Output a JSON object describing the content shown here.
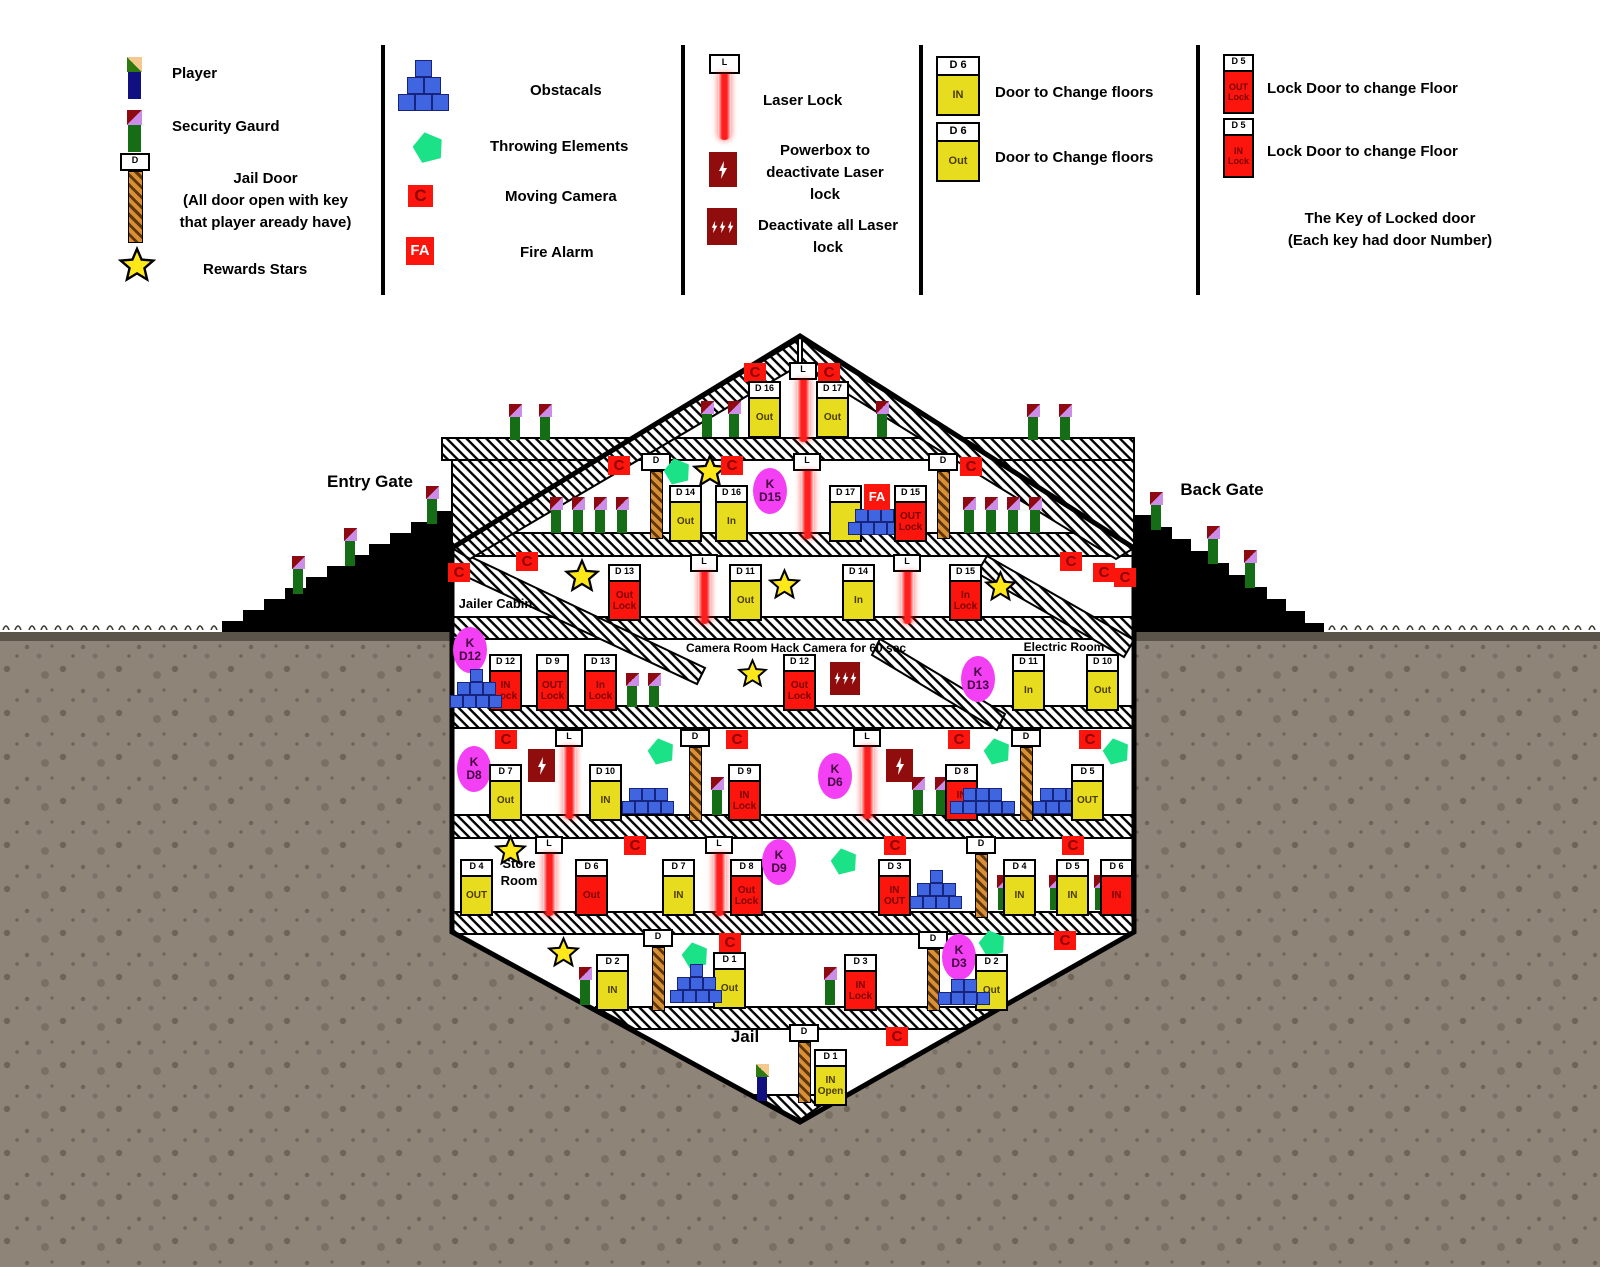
{
  "legend": {
    "player": "Player",
    "guard": "Security Gaurd",
    "jail_door": "Jail Door\n(All door open with key\nthat player aready have)",
    "stars": "Rewards Stars",
    "obstacals": "Obstacals",
    "throwing": "Throwing Elements",
    "moving_camera": "Moving Camera",
    "fire_alarm": "Fire Alarm",
    "laser": "Laser Lock",
    "powerbox": "Powerbox to\ndeactivate Laser\nlock",
    "powerbox_all": "Deactivate all Laser\nlock",
    "door_change_1": "Door to Change floors",
    "door_change_2": "Door to Change floors",
    "lock_door_1": "Lock Door to change Floor",
    "lock_door_2": "Lock Door to change Floor",
    "key_note": "The Key of Locked door\n(Each key had door Number)",
    "icons": {
      "cam": "C",
      "fa": "FA",
      "laser_l": "L",
      "jail_d": "D",
      "key_k": "K",
      "door_in": {
        "h": "D 6",
        "b": "IN"
      },
      "door_out": {
        "h": "D 6",
        "b": "Out"
      },
      "door_outlock": {
        "h": "D 5",
        "b": "OUT\nLock"
      },
      "door_inlock": {
        "h": "D 5",
        "b": "IN\nLock"
      }
    }
  },
  "map": {
    "labels": {
      "entry_gate": "Entry Gate",
      "back_gate": "Back Gate",
      "jailer_cabin": "Jailer Cabin",
      "camera_room": "Camera Room Hack Camera for 60 sec",
      "electric_room": "Electric Room",
      "store_room": "Store\nRoom",
      "jail": "Jail"
    },
    "items": [
      {
        "t": "guard",
        "x": 508,
        "y": 404
      },
      {
        "t": "guard",
        "x": 538,
        "y": 404
      },
      {
        "t": "guard",
        "x": 1026,
        "y": 404
      },
      {
        "t": "guard",
        "x": 1058,
        "y": 404
      },
      {
        "t": "guard",
        "x": 700,
        "y": 401
      },
      {
        "t": "guard",
        "x": 727,
        "y": 401
      },
      {
        "t": "guard",
        "x": 875,
        "y": 401
      },
      {
        "t": "cam",
        "x": 744,
        "y": 363
      },
      {
        "t": "cam",
        "x": 818,
        "y": 363
      },
      {
        "t": "laser",
        "x": 789,
        "y": 362,
        "len": 62
      },
      {
        "t": "door",
        "x": 748,
        "y": 381,
        "head": "D 16",
        "body": "Out",
        "c": "y"
      },
      {
        "t": "door",
        "x": 816,
        "y": 381,
        "head": "D 17",
        "body": "Out",
        "c": "y"
      },
      {
        "t": "cam",
        "x": 608,
        "y": 456
      },
      {
        "t": "jdoor",
        "x": 641,
        "y": 453,
        "len": 66
      },
      {
        "t": "guard",
        "x": 549,
        "y": 497
      },
      {
        "t": "guard",
        "x": 571,
        "y": 497
      },
      {
        "t": "guard",
        "x": 593,
        "y": 497
      },
      {
        "t": "guard",
        "x": 615,
        "y": 497
      },
      {
        "t": "pent",
        "x": 664,
        "y": 458
      },
      {
        "t": "star",
        "x": 692,
        "y": 453,
        "s": 36
      },
      {
        "t": "cam",
        "x": 721,
        "y": 456
      },
      {
        "t": "door",
        "x": 669,
        "y": 485,
        "head": "D 14",
        "body": "Out",
        "c": "y"
      },
      {
        "t": "door",
        "x": 715,
        "y": 485,
        "head": "D 16",
        "body": "In",
        "c": "y"
      },
      {
        "t": "key",
        "x": 753,
        "y": 468,
        "l1": "K",
        "l2": "D15"
      },
      {
        "t": "laser",
        "x": 793,
        "y": 453,
        "len": 68
      },
      {
        "t": "door",
        "x": 829,
        "y": 485,
        "head": "D 17",
        "body": "",
        "c": "y"
      },
      {
        "t": "blocks",
        "x": 848,
        "y": 496,
        "rows": [
          1,
          3,
          4
        ],
        "cell": 13
      },
      {
        "t": "fa",
        "x": 864,
        "y": 484
      },
      {
        "t": "door",
        "x": 894,
        "y": 485,
        "head": "D 15",
        "body": "OUT\nLock",
        "c": "r"
      },
      {
        "t": "jdoor",
        "x": 928,
        "y": 453,
        "len": 66
      },
      {
        "t": "cam",
        "x": 960,
        "y": 457
      },
      {
        "t": "guard",
        "x": 962,
        "y": 497
      },
      {
        "t": "guard",
        "x": 984,
        "y": 497
      },
      {
        "t": "guard",
        "x": 1006,
        "y": 497
      },
      {
        "t": "guard",
        "x": 1028,
        "y": 497
      },
      {
        "t": "cam",
        "x": 448,
        "y": 563
      },
      {
        "t": "cam",
        "x": 516,
        "y": 552
      },
      {
        "t": "star",
        "x": 564,
        "y": 558,
        "s": 36
      },
      {
        "t": "door",
        "x": 608,
        "y": 564,
        "head": "D 13",
        "body": "Out\nLock",
        "c": "r"
      },
      {
        "t": "laser",
        "x": 690,
        "y": 554,
        "len": 52
      },
      {
        "t": "door",
        "x": 729,
        "y": 564,
        "head": "D 11",
        "body": "Out",
        "c": "y"
      },
      {
        "t": "star",
        "x": 768,
        "y": 568,
        "s": 33
      },
      {
        "t": "door",
        "x": 842,
        "y": 564,
        "head": "D 14",
        "body": "In",
        "c": "y"
      },
      {
        "t": "laser",
        "x": 893,
        "y": 554,
        "len": 52
      },
      {
        "t": "door",
        "x": 949,
        "y": 564,
        "head": "D 15",
        "body": "In\nLock",
        "c": "r"
      },
      {
        "t": "star",
        "x": 984,
        "y": 570,
        "s": 33
      },
      {
        "t": "cam",
        "x": 1060,
        "y": 552
      },
      {
        "t": "cam",
        "x": 1093,
        "y": 563
      },
      {
        "t": "key",
        "x": 453,
        "y": 627,
        "l1": "K",
        "l2": "D12"
      },
      {
        "t": "door",
        "x": 489,
        "y": 654,
        "head": "D 12",
        "body": "IN\nLock",
        "c": "r"
      },
      {
        "t": "blocks",
        "x": 450,
        "y": 669,
        "rows": [
          1,
          3,
          4
        ],
        "cell": 13
      },
      {
        "t": "door",
        "x": 536,
        "y": 654,
        "head": "D 9",
        "body": "OUT\nLock",
        "c": "r"
      },
      {
        "t": "door",
        "x": 584,
        "y": 654,
        "head": "D 13",
        "body": "In\nLock",
        "c": "r"
      },
      {
        "t": "guard",
        "x": 625,
        "y": 673,
        "h": 34
      },
      {
        "t": "guard",
        "x": 647,
        "y": 673,
        "h": 34
      },
      {
        "t": "star",
        "x": 737,
        "y": 658,
        "s": 31
      },
      {
        "t": "door",
        "x": 783,
        "y": 654,
        "head": "D 12",
        "body": "Out\nLock",
        "c": "r"
      },
      {
        "t": "pba",
        "x": 830,
        "y": 662
      },
      {
        "t": "key",
        "x": 961,
        "y": 656,
        "l1": "K",
        "l2": "D13"
      },
      {
        "t": "door",
        "x": 1012,
        "y": 654,
        "head": "D 11",
        "body": "In",
        "c": "y"
      },
      {
        "t": "door",
        "x": 1086,
        "y": 654,
        "head": "D 10",
        "body": "Out",
        "c": "y"
      },
      {
        "t": "key",
        "x": 457,
        "y": 746,
        "l1": "K",
        "l2": "D8"
      },
      {
        "t": "cam",
        "x": 495,
        "y": 730
      },
      {
        "t": "door",
        "x": 489,
        "y": 764,
        "head": "D 7",
        "body": "Out",
        "c": "y"
      },
      {
        "t": "pb",
        "x": 528,
        "y": 749
      },
      {
        "t": "laser",
        "x": 555,
        "y": 729,
        "len": 72
      },
      {
        "t": "door",
        "x": 589,
        "y": 764,
        "head": "D 10",
        "body": "IN",
        "c": "y"
      },
      {
        "t": "pent",
        "x": 648,
        "y": 738
      },
      {
        "t": "blocks",
        "x": 622,
        "y": 788,
        "rows": [
          3,
          4
        ],
        "cell": 13
      },
      {
        "t": "jdoor",
        "x": 680,
        "y": 729,
        "len": 72
      },
      {
        "t": "guard",
        "x": 710,
        "y": 777,
        "h": 38
      },
      {
        "t": "cam",
        "x": 726,
        "y": 730
      },
      {
        "t": "door",
        "x": 728,
        "y": 764,
        "head": "D 9",
        "body": "IN\nLock",
        "c": "r"
      },
      {
        "t": "key",
        "x": 818,
        "y": 753,
        "l1": "K",
        "l2": "D6"
      },
      {
        "t": "laser",
        "x": 853,
        "y": 729,
        "len": 72
      },
      {
        "t": "pb",
        "x": 886,
        "y": 749
      },
      {
        "t": "guard",
        "x": 911,
        "y": 777,
        "h": 38
      },
      {
        "t": "guard",
        "x": 934,
        "y": 777,
        "h": 38
      },
      {
        "t": "cam",
        "x": 948,
        "y": 730
      },
      {
        "t": "door",
        "x": 945,
        "y": 764,
        "head": "D 8",
        "body": "IN\nLock",
        "c": "r"
      },
      {
        "t": "pent",
        "x": 984,
        "y": 738
      },
      {
        "t": "blocks",
        "x": 950,
        "y": 788,
        "rows": [
          3,
          5
        ],
        "cell": 13
      },
      {
        "t": "jdoor",
        "x": 1011,
        "y": 729,
        "len": 72
      },
      {
        "t": "blocks",
        "x": 1033,
        "y": 788,
        "rows": [
          3,
          4
        ],
        "cell": 13
      },
      {
        "t": "cam",
        "x": 1079,
        "y": 730
      },
      {
        "t": "door",
        "x": 1071,
        "y": 764,
        "head": "D 5",
        "body": "OUT",
        "c": "y"
      },
      {
        "t": "pent",
        "x": 1103,
        "y": 738
      },
      {
        "t": "door",
        "x": 460,
        "y": 859,
        "head": "D 4",
        "body": "OUT",
        "c": "y"
      },
      {
        "t": "star",
        "x": 494,
        "y": 834,
        "s": 33
      },
      {
        "t": "laser",
        "x": 535,
        "y": 836,
        "len": 62
      },
      {
        "t": "door",
        "x": 575,
        "y": 859,
        "head": "D 6",
        "body": "Out",
        "c": "r"
      },
      {
        "t": "cam",
        "x": 624,
        "y": 836
      },
      {
        "t": "door",
        "x": 662,
        "y": 859,
        "head": "D 7",
        "body": "IN",
        "c": "y"
      },
      {
        "t": "laser",
        "x": 705,
        "y": 836,
        "len": 62
      },
      {
        "t": "door",
        "x": 730,
        "y": 859,
        "head": "D 8",
        "body": "Out\nLock",
        "c": "r"
      },
      {
        "t": "key",
        "x": 762,
        "y": 839,
        "l1": "K",
        "l2": "D9"
      },
      {
        "t": "pent",
        "x": 831,
        "y": 848
      },
      {
        "t": "cam",
        "x": 884,
        "y": 836
      },
      {
        "t": "door",
        "x": 878,
        "y": 859,
        "head": "D 3",
        "body": "IN\nOUT",
        "c": "r"
      },
      {
        "t": "blocks",
        "x": 910,
        "y": 870,
        "rows": [
          1,
          3,
          4
        ],
        "cell": 13
      },
      {
        "t": "jdoor",
        "x": 966,
        "y": 836,
        "len": 62
      },
      {
        "t": "guard",
        "x": 996,
        "y": 875,
        "h": 35
      },
      {
        "t": "door",
        "x": 1003,
        "y": 859,
        "head": "D 4",
        "body": "IN",
        "c": "y"
      },
      {
        "t": "cam",
        "x": 1062,
        "y": 836
      },
      {
        "t": "guard",
        "x": 1048,
        "y": 875,
        "h": 35
      },
      {
        "t": "door",
        "x": 1056,
        "y": 859,
        "head": "D 5",
        "body": "IN",
        "c": "y"
      },
      {
        "t": "guard",
        "x": 1093,
        "y": 875,
        "h": 35
      },
      {
        "t": "door",
        "x": 1100,
        "y": 859,
        "head": "D 6",
        "body": "IN",
        "c": "r"
      },
      {
        "t": "star",
        "x": 547,
        "y": 936,
        "s": 33
      },
      {
        "t": "guard",
        "x": 578,
        "y": 967,
        "h": 38
      },
      {
        "t": "door",
        "x": 596,
        "y": 954,
        "head": "D 2",
        "body": "IN",
        "c": "y"
      },
      {
        "t": "jdoor",
        "x": 643,
        "y": 929,
        "len": 62
      },
      {
        "t": "pent",
        "x": 682,
        "y": 942
      },
      {
        "t": "door",
        "x": 713,
        "y": 952,
        "head": "D 1",
        "body": "Out",
        "c": "y"
      },
      {
        "t": "blocks",
        "x": 670,
        "y": 964,
        "rows": [
          1,
          3,
          4
        ],
        "cell": 13
      },
      {
        "t": "cam",
        "x": 719,
        "y": 933
      },
      {
        "t": "guard",
        "x": 823,
        "y": 967,
        "h": 38
      },
      {
        "t": "door",
        "x": 844,
        "y": 954,
        "head": "D 3",
        "body": "IN\nLock",
        "c": "r"
      },
      {
        "t": "jdoor",
        "x": 918,
        "y": 931,
        "len": 60
      },
      {
        "t": "key",
        "x": 942,
        "y": 934,
        "l1": "K",
        "l2": "D3"
      },
      {
        "t": "pent",
        "x": 979,
        "y": 930
      },
      {
        "t": "door",
        "x": 975,
        "y": 954,
        "head": "D 2",
        "body": "Out",
        "c": "y"
      },
      {
        "t": "blocks",
        "x": 938,
        "y": 979,
        "rows": [
          2,
          4
        ],
        "cell": 13
      },
      {
        "t": "cam",
        "x": 1054,
        "y": 931
      },
      {
        "t": "guard",
        "x": 755,
        "y": 1064,
        "h": 37,
        "player": true
      },
      {
        "t": "jdoor",
        "x": 789,
        "y": 1024,
        "len": 59
      },
      {
        "t": "door",
        "x": 814,
        "y": 1049,
        "head": "D 1",
        "body": "IN\nOpen",
        "c": "y"
      },
      {
        "t": "cam",
        "x": 886,
        "y": 1027
      },
      {
        "t": "guard",
        "x": 291,
        "y": 556,
        "h": 38
      },
      {
        "t": "guard",
        "x": 343,
        "y": 528,
        "h": 38
      },
      {
        "t": "guard",
        "x": 425,
        "y": 486,
        "h": 38
      },
      {
        "t": "guard",
        "x": 1149,
        "y": 492,
        "h": 38
      },
      {
        "t": "guard",
        "x": 1206,
        "y": 526,
        "h": 38
      },
      {
        "t": "guard",
        "x": 1243,
        "y": 550,
        "h": 38
      },
      {
        "t": "cam",
        "x": 1114,
        "y": 568
      }
    ]
  },
  "colors": {
    "yellow_door": "#e8dc1f",
    "red_door": "#fb150c",
    "camera": "#fb150c",
    "powerbox": "#8f0d0d",
    "key": "#f440f4",
    "throwing_element": "#1be287",
    "obstacle_block": "#3f66e0",
    "laser_beam": "#ff1e1e",
    "guard_green": "#156e15",
    "player_navy": "#101080",
    "jail_bar": "#d98f35",
    "ground": "#8e8478"
  }
}
